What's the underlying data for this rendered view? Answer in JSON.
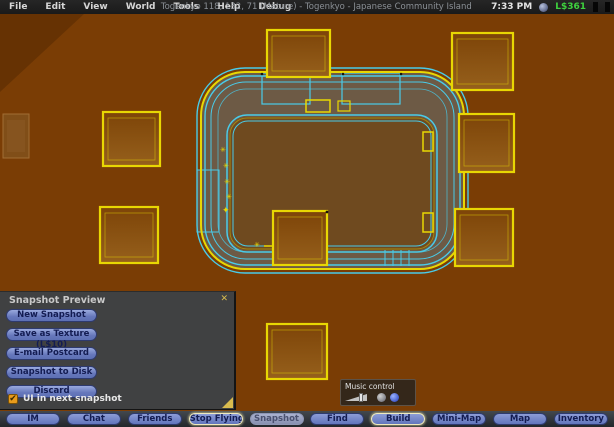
{
  "menubar": {
    "menus": [
      "File",
      "Edit",
      "View",
      "World",
      "Tools",
      "Help",
      "Debug"
    ],
    "title": "Togenkyo 118, 132, 71 (Mature) - Togenkyo - Japanese Community Island",
    "time": "7:33 PM",
    "balance": "L$361",
    "balance_color": "#3ed23e"
  },
  "snapshot_dialog": {
    "title": "Snapshot Preview",
    "close_label": "✕",
    "buttons": [
      "New Snapshot",
      "Save as Texture (L$10)",
      "E-mail Postcard",
      "Snapshot to Disk",
      "Discard"
    ],
    "checkbox_label": "UI in next snapshot",
    "checkbox_checked": true,
    "checkbox_glyph": "✔"
  },
  "music_control": {
    "title": "Music control"
  },
  "toolbar": {
    "buttons": [
      {
        "label": "IM",
        "state": "normal"
      },
      {
        "label": "Chat",
        "state": "normal"
      },
      {
        "label": "Friends",
        "state": "normal"
      },
      {
        "label": "Stop Flying",
        "state": "highlighted"
      },
      {
        "label": "Snapshot",
        "state": "pressed"
      },
      {
        "label": "Find",
        "state": "normal"
      },
      {
        "label": "Build",
        "state": "highlighted"
      },
      {
        "label": "Mini-Map",
        "state": "normal"
      },
      {
        "label": "Map",
        "state": "normal"
      },
      {
        "label": "Inventory",
        "state": "normal"
      }
    ]
  },
  "scene": {
    "mode": "wireframe-view",
    "colors": {
      "bg": "#7a3d05",
      "band": "#6d5a45",
      "courtyard": "#6f4a1f",
      "cyan": "#49cbe9",
      "yellow": "#e8d703",
      "boxfill_top": "#7d4408",
      "boxfill_bottom": "#96601c"
    }
  }
}
